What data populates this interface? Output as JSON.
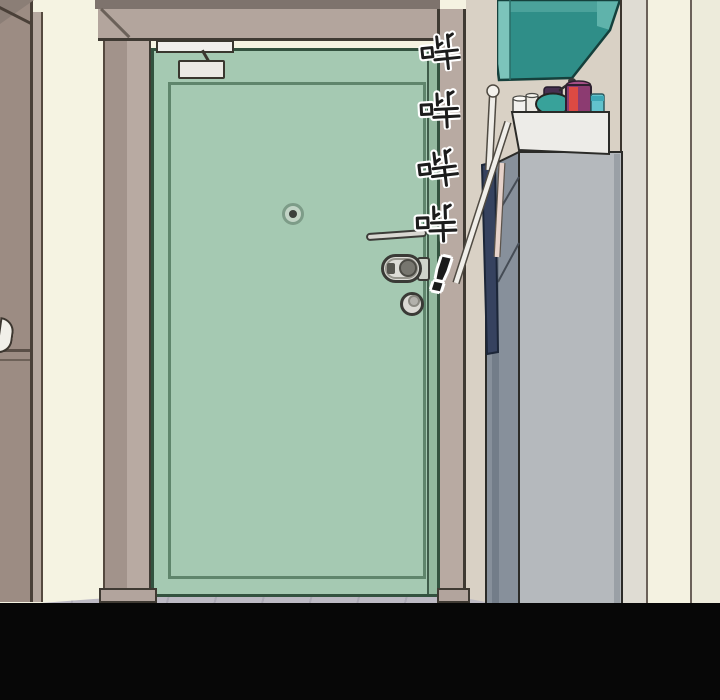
{
  "panel": {
    "sfx_vertical": {
      "chars": [
        "哔",
        "哔",
        "哔",
        "哔"
      ],
      "exclamation": "!",
      "meaning": "beeping sound effect"
    },
    "palette": {
      "door_green": "#a5c9b2",
      "door_outline": "#33523f",
      "door_inner_panel_line": "#5f856c",
      "frame_taupe": "#b3a59d",
      "frame_shadow": "#7e736d",
      "left_door_taupe": "#9c8c83",
      "wall_cream": "#f5f3e2",
      "wall_beige": "#d9d1c5",
      "overhead_cabinet_teal": "#2f8e88",
      "shoe_cabinet_gray": "#b5b9bd",
      "shoe_cabinet_side": "#87909b",
      "umbrella_navy": "#36425f",
      "magenta_bottle": "#8c3b71",
      "red_stripe": "#dd4a43",
      "cyan_jar": "#62c3cd",
      "teal_pot": "#38a29a",
      "floor_gray": "#bdbac4",
      "letterbox_black": "#070707",
      "sfx_fill": "#1c1c1c",
      "sfx_outline": "#ffffff"
    }
  }
}
